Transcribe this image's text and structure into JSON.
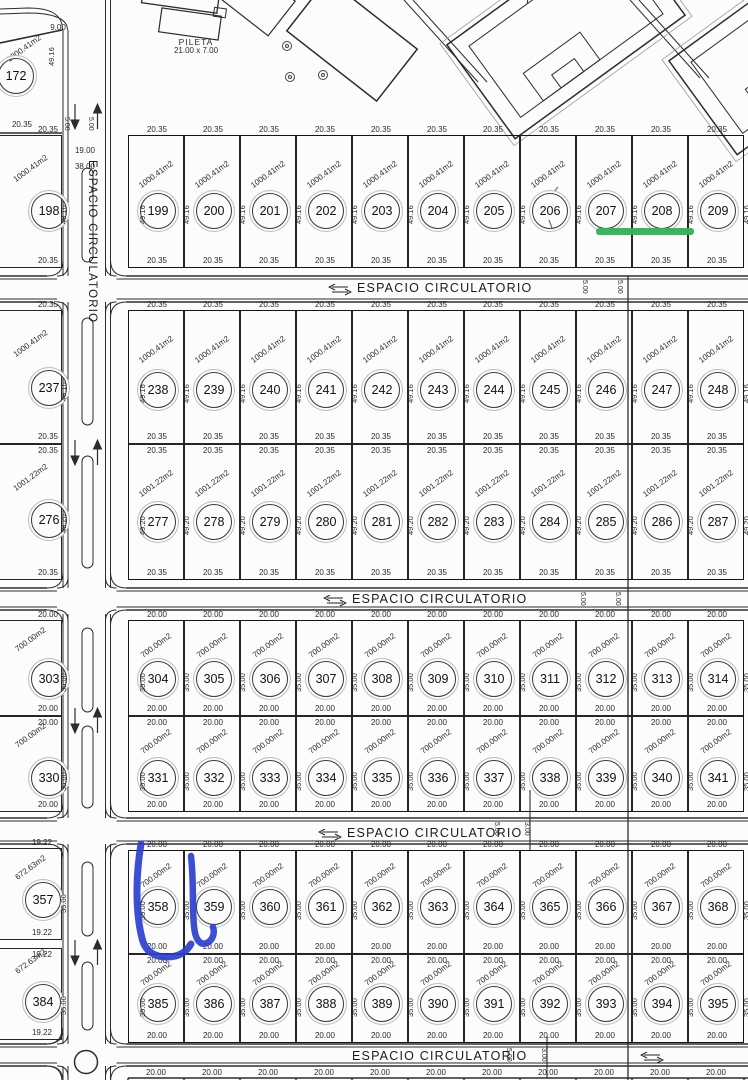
{
  "map": {
    "road_label": "ESPACIO CIRCULATORIO",
    "pool": {
      "name": "PILETA",
      "dims": "21.00 x 7.00"
    },
    "lot_172": {
      "number": "172",
      "area": "1000.41m2",
      "width": "20.35",
      "depth": "49.16",
      "side_dim": "9.00"
    },
    "vertical_road": {
      "lane1": "5.00",
      "lane2": "5.00",
      "dim1": "19.00",
      "dim2": "38.00"
    },
    "band_dims": [
      [
        "5.00",
        "5.00"
      ],
      [
        "5.00",
        "5.00"
      ],
      [
        "5.00",
        "3.00"
      ],
      [
        "5.00",
        "3.00"
      ]
    ],
    "rows": [
      {
        "area": "1000.41m2",
        "width": "20.35",
        "depth": "49.16",
        "left_lot": {
          "number": "198",
          "area": "1000.41m2",
          "width": "20.35",
          "depth": "49.16"
        },
        "lots": [
          "199",
          "200",
          "201",
          "202",
          "203",
          "204",
          "205",
          "206",
          "207",
          "208",
          "209"
        ]
      },
      {
        "area": "1000.41m2",
        "width": "20.35",
        "depth": "49.16",
        "left_lot": {
          "number": "237",
          "area": "1000.41m2",
          "width": "20.35",
          "depth": "49.16"
        },
        "lots": [
          "238",
          "239",
          "240",
          "241",
          "242",
          "243",
          "244",
          "245",
          "246",
          "247",
          "248"
        ]
      },
      {
        "area": "1001.22m2",
        "width": "20.35",
        "depth": "49.20",
        "left_lot": {
          "number": "276",
          "area": "1001.22m2",
          "width": "20.35",
          "depth": "49.20"
        },
        "lots": [
          "277",
          "278",
          "279",
          "280",
          "281",
          "282",
          "283",
          "284",
          "285",
          "286",
          "287"
        ]
      },
      {
        "area": "700.00m2",
        "width": "20.00",
        "depth": "35.00",
        "left_lot": {
          "number": "303",
          "area": "700.00m2",
          "width": "20.00",
          "depth": "35.00"
        },
        "lots": [
          "304",
          "305",
          "306",
          "307",
          "308",
          "309",
          "310",
          "311",
          "312",
          "313",
          "314"
        ]
      },
      {
        "area": "700.00m2",
        "width": "20.00",
        "depth": "35.00",
        "left_lot": {
          "number": "330",
          "area": "700.00m2",
          "width": "20.00",
          "depth": "35.00"
        },
        "lots": [
          "331",
          "332",
          "333",
          "334",
          "335",
          "336",
          "337",
          "338",
          "339",
          "340",
          "341"
        ]
      },
      {
        "area": "700.00m2",
        "width": "20.00",
        "depth": "35.00",
        "left_lot": {
          "number": "357",
          "area": "672.63m2",
          "width": "19.22",
          "depth": "35.00"
        },
        "lots": [
          "358",
          "359",
          "360",
          "361",
          "362",
          "363",
          "364",
          "365",
          "366",
          "367",
          "368"
        ]
      },
      {
        "area": "700.00m2",
        "width": "20.00",
        "depth": "35.00",
        "left_lot": {
          "number": "384",
          "area": "672.63m2",
          "width": "19.22",
          "depth": "35.00"
        },
        "lots": [
          "385",
          "386",
          "387",
          "388",
          "389",
          "390",
          "391",
          "392",
          "393",
          "394",
          "395"
        ]
      }
    ],
    "bottom_row_width": "20.00",
    "annotations": {
      "green_underline": {
        "near_lot": "208",
        "color": "#2fb254"
      },
      "blue_pen_bracket": {
        "circled_lot": "358",
        "color": "#2b40cf"
      }
    }
  }
}
